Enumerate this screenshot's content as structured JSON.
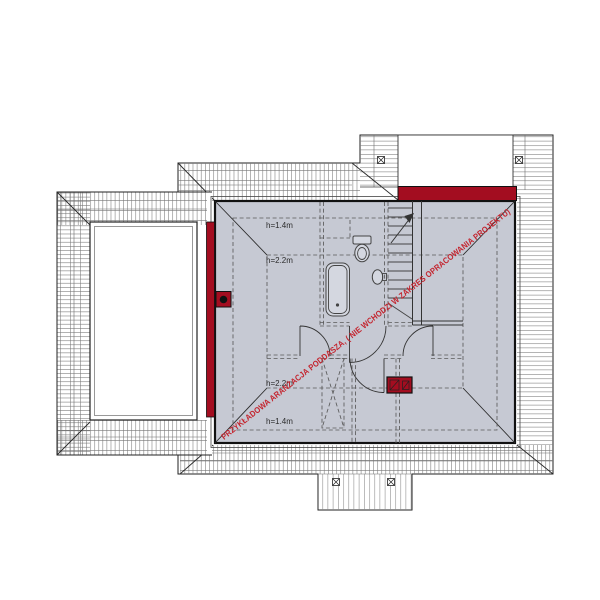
{
  "watermark": {
    "text": "PRZYKŁADOWA ARANŻACJA PODDASZA, ( NIE WCHODZI W ZAKRES OPRACOWANIA PROJEKTU)",
    "color": "#c4242e"
  },
  "annotations": {
    "top_outer": "h=1.4m",
    "top_inner": "h=2.2m",
    "bottom_inner": "h=2.2m",
    "bottom_outer": "h=1.4m"
  },
  "colors": {
    "attic_floor": "#c6c9d3",
    "masonry_red": "#a30d20",
    "hatch_gray": "#6e6e6e",
    "outline_black": "#1c1c1c"
  }
}
